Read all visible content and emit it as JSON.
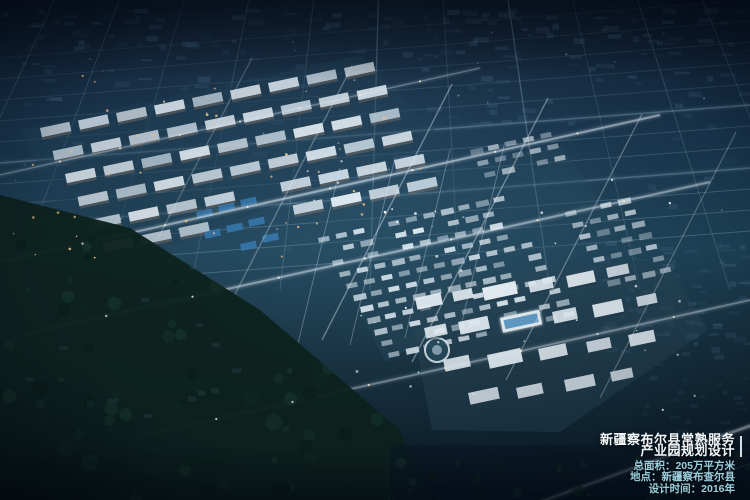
{
  "overlay": {
    "title_line1": "新疆察布尔县常熟服务",
    "title_line2": "产业园规划设计",
    "stats": [
      "总面积：205万平方米",
      "地点：新疆察布查尔县",
      "设计时间：2016年"
    ]
  },
  "palette": {
    "sky_top": "#0a1628",
    "city_mid": "#1f4459",
    "dim_block": "#4a708e",
    "grid_line": "#a9cde0",
    "road_glow": "#eaf6ff",
    "warm_light": "#ffcf8f",
    "building_lit": "#dde9f2",
    "building_facade": "#8a7668",
    "civic": "#ecf5fb",
    "civic_roof": "#5e9bc8",
    "water": "#3a7fb8",
    "forest": "#0e241f",
    "title_color": "#f2f7fa",
    "stats_color": "#9ccfde"
  }
}
